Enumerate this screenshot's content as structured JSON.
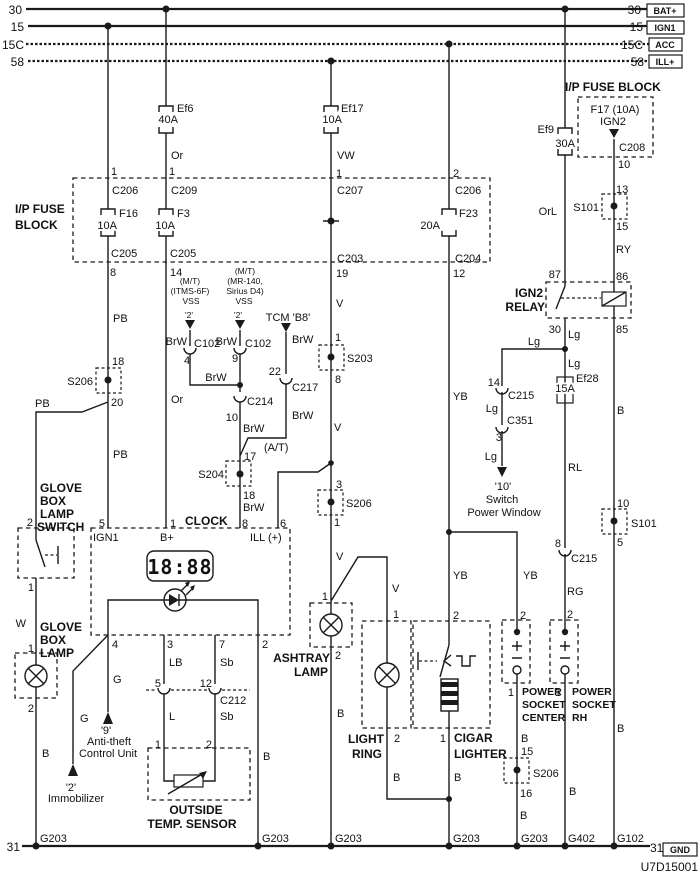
{
  "diagram_code": "U7D15001",
  "buses": {
    "b30": "30",
    "b15": "15",
    "b15c": "15C",
    "b58": "58",
    "b31": "31",
    "tags": {
      "bat": "BAT+",
      "ign1": "IGN1",
      "acc": "ACC",
      "ill": "ILL+",
      "gnd": "GND"
    }
  },
  "L": {
    "busL30": "30",
    "busL15": "15",
    "busL15c": "15C",
    "busL58": "58",
    "busR30": "30",
    "busR15": "15",
    "busR15c": "15C",
    "busR58": "58",
    "tagBat": "BAT+",
    "tagIgn1": "IGN1",
    "tagAcc": "ACC",
    "tagIll": "ILL+",
    "ef6": "Ef6",
    "ef6A": "40A",
    "ef17": "Ef17",
    "ef17A": "10A",
    "ef9": "Ef9",
    "ef9A": "30A",
    "f16": "F16",
    "f16A": "10A",
    "f3": "F3",
    "f3A": "10A",
    "f23": "F23",
    "f23A": "20A",
    "ef28": "Ef28",
    "ef28A": "15A",
    "ipTitle1": "I/P FUSE",
    "ipTitle2": "BLOCK",
    "fbTitle": "I/P FUSE BLOCK",
    "fbF17": "F17 (10A)",
    "fbIGN2": "IGN2",
    "fC208": "C208",
    "a1": "1",
    "aC206": "C206",
    "aC205": "C205",
    "a8": "8",
    "aPB1": "PB",
    "a18": "18",
    "aS206": "S206",
    "a20": "20",
    "aPB2": "PB",
    "a5": "5",
    "aIGN1": "IGN1",
    "aG": "G",
    "a9q": "'9'",
    "aAnti": "Anti-theft",
    "aCtrl": "Control Unit",
    "gPB": "PB",
    "g2a": "2",
    "gsw1": "GLOVE",
    "gsw2": "BOX",
    "gsw3": "LAMP",
    "gsw4": "SWITCH",
    "g1a": "1",
    "gW": "W",
    "glp1": "GLOVE",
    "glp2": "BOX",
    "glp3": "LAMP",
    "g1b": "1",
    "g2b": "2",
    "gB": "B",
    "hG": "G",
    "h2q": "'2'",
    "hImm": "Immobilizer",
    "bOr1": "Or",
    "b1": "1",
    "bC209": "C209",
    "bC205": "C205",
    "b14": "14",
    "bOr2": "Or",
    "iMT": "(M/T)",
    "iITMS": "(ITMS-6F)",
    "iVSS": "VSS",
    "i2q": "'2'",
    "iBrW": "BrW",
    "iC102": "C102",
    "i4": "4",
    "jMT": "(M/T)",
    "jMR": "(MR-140,",
    "jSir": "Sirius D4)",
    "jVSS": "VSS",
    "j2q": "'2'",
    "jBrW": "BrW",
    "jC102": "C102",
    "j9": "9",
    "jBrW2": "BrW",
    "jC214": "C214",
    "j10": "10",
    "jBrW3": "BrW",
    "at": "(A/T)",
    "j17": "17",
    "jS204": "S204",
    "j18": "18",
    "jBrW4": "BrW",
    "kTCM": "TCM 'B8'",
    "kBrW": "BrW",
    "k22": "22",
    "kC217": "C217",
    "kBrW2": "BrW",
    "cVW": "VW",
    "c1a": "1",
    "cC207": "C207",
    "cC203": "C203",
    "c19": "19",
    "cV1": "V",
    "c1b": "1",
    "cS203": "S203",
    "c8": "8",
    "cV2": "V",
    "c3": "3",
    "cS206": "S206",
    "c1c": "1",
    "cV3": "V",
    "c1d": "1",
    "ash1": "ASHTRAY",
    "ash2": "LAMP",
    "c2b": "2",
    "cB": "B",
    "clkTitle": "CLOCK",
    "clk1": "1",
    "clkB": "B+",
    "clk8": "8",
    "clk6": "6",
    "clkIll": "ILL (+)",
    "clkDisp": "18:88",
    "clk4": "4",
    "clk3": "3",
    "clk7": "7",
    "clk2": "2",
    "oLB": "LB",
    "pSb": "Sb",
    "o5": "5",
    "p12": "12",
    "c212": "C212",
    "oL": "L",
    "pSb2": "Sb",
    "o1": "1",
    "p2": "2",
    "temp1": "OUTSIDE",
    "temp2": "TEMP. SENSOR",
    "qB": "B",
    "nV": "V",
    "n1": "1",
    "nLight": "LIGHT",
    "nRing": "RING",
    "n2": "2",
    "nB": "B",
    "d2a": "2",
    "dC206": "C206",
    "dC204": "C204",
    "d12": "12",
    "dYB1": "YB",
    "dYB2": "YB",
    "d2b": "2",
    "d1": "1",
    "dCig1": "CIGAR",
    "dCig2": "LIGHTER",
    "dB": "B",
    "mYB": "YB",
    "m2": "2",
    "m1": "1",
    "mP1": "POWER",
    "mP2": "SOCKET",
    "mP3": "CENTER",
    "mB1": "B",
    "m15": "15",
    "mS206": "S206",
    "m16": "16",
    "mB2": "B",
    "eOrL": "OrL",
    "e87": "87",
    "eR1": "IGN2",
    "eR2": "RELAY",
    "e30": "30",
    "eLg1": "Lg",
    "eLg2": "Lg",
    "eRL": "RL",
    "e8": "8",
    "eC215": "C215",
    "eRG": "RG",
    "e2": "2",
    "e1": "1",
    "eP1": "POWER",
    "eP2": "SOCKET",
    "eP3": "RH",
    "eB": "B",
    "lLg0": "Lg",
    "l14": "14",
    "lC215": "C215",
    "lLg1": "Lg",
    "lC351": "C351",
    "l3": "3",
    "lLg2": "Lg",
    "l10": "'10'",
    "lSw": "Switch",
    "lPW": "Power Window",
    "f10a": "10",
    "f13": "13",
    "fS101a": "S101",
    "f15": "15",
    "fRY": "RY",
    "f86": "86",
    "f85": "85",
    "fB1": "B",
    "f10b": "10",
    "fS101b": "S101",
    "f5": "5",
    "fB2": "B",
    "gnd31L": "31",
    "G203a": "G203",
    "G203b": "G203",
    "G203c": "G203",
    "G203d": "G203",
    "G203e": "G203",
    "G402": "G402",
    "G102": "G102",
    "gnd31R": "31",
    "gndTag": "GND",
    "code": "U7D15001"
  }
}
